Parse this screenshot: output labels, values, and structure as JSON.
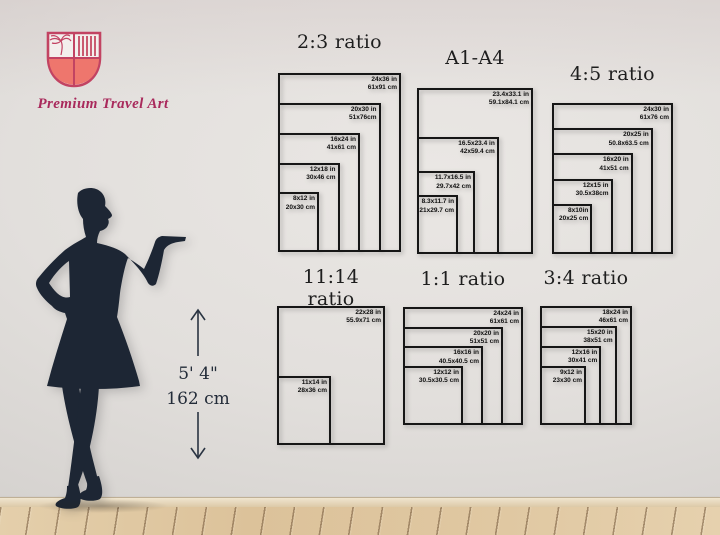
{
  "brand": {
    "name": "Premium Travel Art"
  },
  "model": {
    "height_ft": "5' 4\"",
    "height_cm": "162 cm"
  },
  "charts": [
    {
      "title": "2:3 ratio",
      "sizes": [
        {
          "inch": "24x36 in",
          "cm": "61x91 cm",
          "w": 24,
          "h": 36
        },
        {
          "inch": "20x30 in",
          "cm": "51x76cm",
          "w": 20,
          "h": 30
        },
        {
          "inch": "16x24 in",
          "cm": "41x61 cm",
          "w": 16,
          "h": 24
        },
        {
          "inch": "12x18 in",
          "cm": "30x46 cm",
          "w": 12,
          "h": 18
        },
        {
          "inch": "8x12 in",
          "cm": "20x30 cm",
          "w": 8,
          "h": 12
        }
      ]
    },
    {
      "title": "A1-A4",
      "sizes": [
        {
          "inch": "23.4x33.1 in",
          "cm": "59.1x84.1 cm",
          "w": 23.4,
          "h": 33.1
        },
        {
          "inch": "16.5x23.4 in",
          "cm": "42x59.4 cm",
          "w": 16.5,
          "h": 23.4
        },
        {
          "inch": "11.7x16.5 in",
          "cm": "29.7x42 cm",
          "w": 11.7,
          "h": 16.5
        },
        {
          "inch": "8.3x11.7 in",
          "cm": "21x29.7 cm",
          "w": 8.3,
          "h": 11.7
        }
      ]
    },
    {
      "title": "4:5 ratio",
      "sizes": [
        {
          "inch": "24x30 in",
          "cm": "61x76 cm",
          "w": 24,
          "h": 30
        },
        {
          "inch": "20x25 in",
          "cm": "50.8x63.5 cm",
          "w": 20,
          "h": 25
        },
        {
          "inch": "16x20 in",
          "cm": "41x51 cm",
          "w": 16,
          "h": 20
        },
        {
          "inch": "12x15 in",
          "cm": "30.5x38cm",
          "w": 12,
          "h": 15
        },
        {
          "inch": "8x10in",
          "cm": "20x25 cm",
          "w": 8,
          "h": 10
        }
      ]
    },
    {
      "title": "11:14 ratio",
      "sizes": [
        {
          "inch": "22x28 in",
          "cm": "55.9x71 cm",
          "w": 22,
          "h": 28
        },
        {
          "inch": "11x14 in",
          "cm": "28x36 cm",
          "w": 11,
          "h": 14
        }
      ]
    },
    {
      "title": "1:1 ratio",
      "sizes": [
        {
          "inch": "24x24 in",
          "cm": "61x61 cm",
          "w": 24,
          "h": 24
        },
        {
          "inch": "20x20 in",
          "cm": "51x51 cm",
          "w": 20,
          "h": 20
        },
        {
          "inch": "16x16 in",
          "cm": "40.5x40.5 cm",
          "w": 16,
          "h": 16
        },
        {
          "inch": "12x12 in",
          "cm": "30.5x30.5 cm",
          "w": 12,
          "h": 12
        }
      ]
    },
    {
      "title": "3:4 ratio",
      "sizes": [
        {
          "inch": "18x24 in",
          "cm": "46x61 cm",
          "w": 18,
          "h": 24
        },
        {
          "inch": "15x20 in",
          "cm": "38x51 cm",
          "w": 15,
          "h": 20
        },
        {
          "inch": "12x16 in",
          "cm": "30x41 cm",
          "w": 12,
          "h": 16
        },
        {
          "inch": "9x12 in",
          "cm": "23x30 cm",
          "w": 9,
          "h": 12
        }
      ]
    }
  ],
  "colors": {
    "brand_outline": "#c24362",
    "brand_fill": "#ee766d",
    "brand_text": "#a92a5c",
    "silhouette": "#1d2634",
    "diagram_line": "#161616"
  }
}
